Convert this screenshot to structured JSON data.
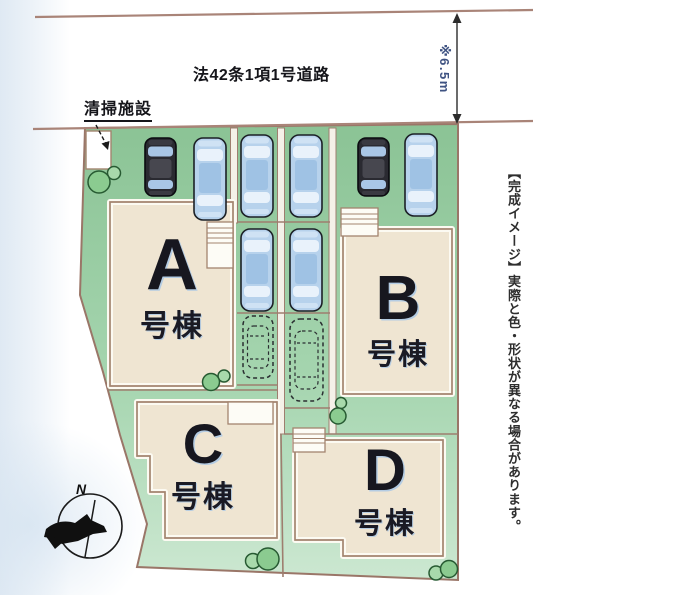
{
  "plan": {
    "road_label": "法42条1項1号道路",
    "road_width_label": "※6.5m",
    "facility_label": "清掃施設",
    "disclaimer": "【完成イメージ】実際と色・形状が異なる場合があります。",
    "compass_north": "N",
    "buildings": [
      {
        "letter": "A",
        "suffix": "号棟"
      },
      {
        "letter": "B",
        "suffix": "号棟"
      },
      {
        "letter": "C",
        "suffix": "号棟"
      },
      {
        "letter": "D",
        "suffix": "号棟"
      }
    ],
    "colors": {
      "lot_green": "#8bc395",
      "lot_green_light": "#cde8d2",
      "building_beige": "#efe5d2",
      "outline_brown": "#9a7668",
      "road_line": "#a98478",
      "car_blue": "#b7d2ec",
      "car_black": "#2a2a31",
      "tree_green": "#8bcb90",
      "dimension_text_blue": "#3f5382"
    }
  }
}
